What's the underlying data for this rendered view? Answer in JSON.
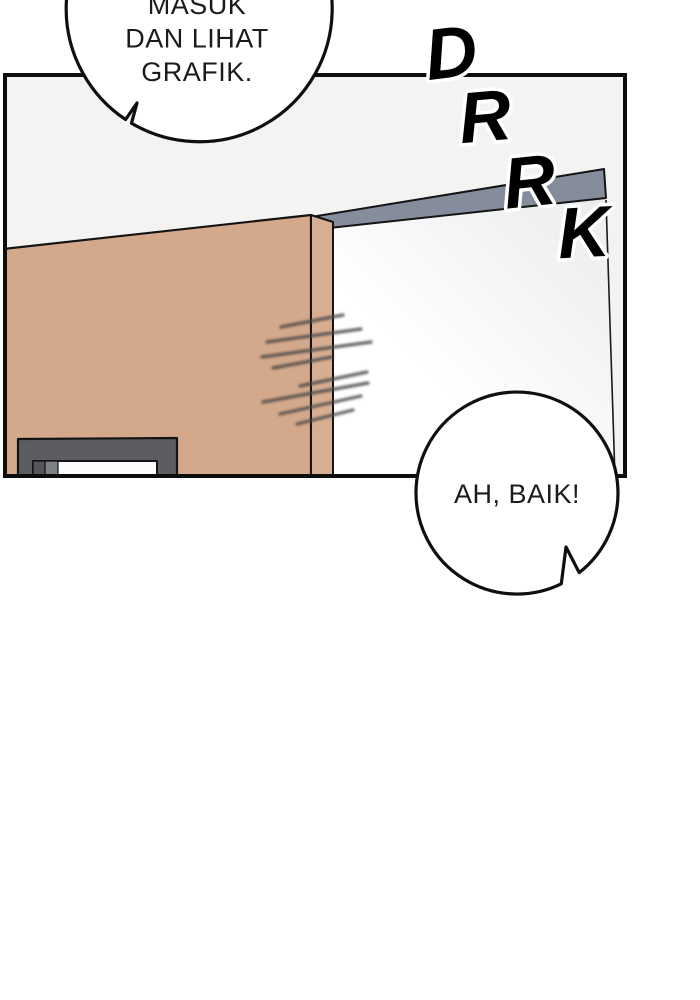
{
  "speech_bubble_top": {
    "lines": [
      "MASUK",
      "DAN LIHAT",
      "GRAFIK."
    ]
  },
  "speech_bubble_bottom": {
    "text": "AH, BAIK!"
  },
  "sfx": {
    "word": "DRRK",
    "letters": [
      "D",
      "R",
      "R",
      "K"
    ]
  },
  "colors": {
    "page_background": "#ffffff",
    "panel_background": "#f4f3f1",
    "panel_border": "#0d0d0d",
    "door_front": "#d4a88a",
    "door_side": "#d8ae92",
    "door_frame_bar": "#858c9c",
    "window_frame": "#5b5d60",
    "window_glass": "#fbfcfd",
    "window_tab_dark": "#54565a",
    "window_tab_mid": "#7d8084"
  }
}
